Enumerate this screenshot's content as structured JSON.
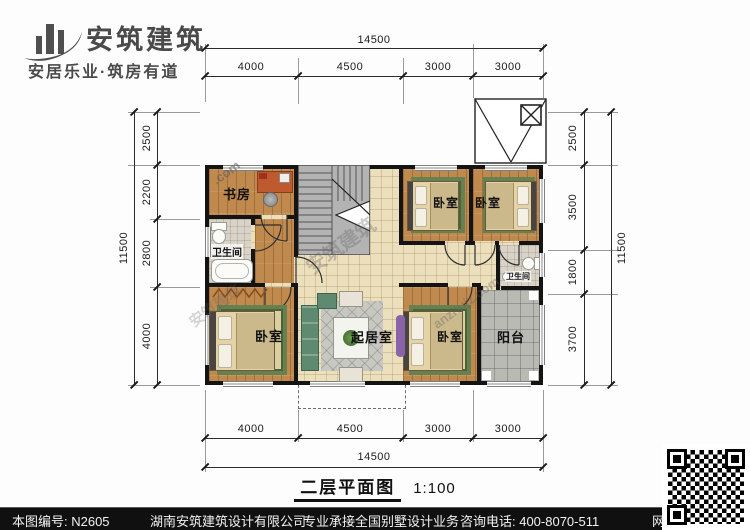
{
  "header": {
    "brand": "安筑建筑",
    "tagline": "安居乐业·筑房有道"
  },
  "dims": {
    "top": {
      "total": "14500",
      "segments": [
        "4000",
        "4500",
        "3000",
        "3000"
      ]
    },
    "bottom": {
      "total": "14500",
      "segments": [
        "4000",
        "4500",
        "3000",
        "3000"
      ]
    },
    "left": {
      "total": "11500",
      "segments": [
        "2500",
        "2200",
        "2800",
        "4000"
      ]
    },
    "right": {
      "total": "11500",
      "segments": [
        "2500",
        "3500",
        "1800",
        "3700"
      ]
    }
  },
  "plan": {
    "rooms": {
      "study": "书房",
      "bathroom": "卫生间",
      "bedroom": "卧室",
      "living": "起居室",
      "balcony": "阳台"
    },
    "watermarks": {
      "dot_com": ".com",
      "brand": "安筑建筑",
      "site": "anzhujz.com"
    }
  },
  "caption": {
    "title": "二层平面图",
    "scale": "1:100"
  },
  "footer": {
    "sheet_no": "本图编号: N2605",
    "company": "湖南安筑建筑设计有限公司",
    "service": "专业承接全国别墅设计业务",
    "phone": "咨询电话: 400-8070-511",
    "badge": "网"
  },
  "colors": {
    "wall": "#141414",
    "wood": "#c08a4e",
    "hall_tile": "#ecdfbc",
    "bath_tile": "#d9d3c7",
    "balcony": "#b9bab4",
    "rug_green": "#66814f",
    "footer_bg": "#101010",
    "accent": "#bf5a2e"
  }
}
